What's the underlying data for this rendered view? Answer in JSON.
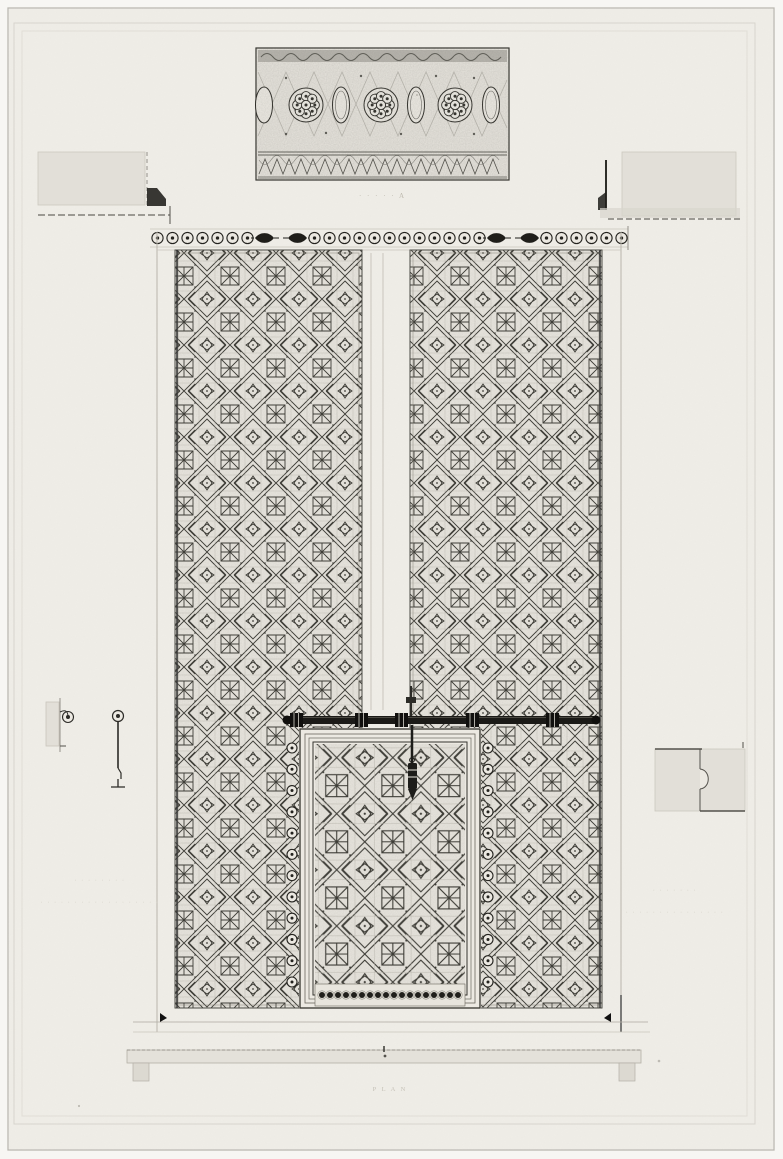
{
  "captions": {
    "frieze": "· · · · ·  A",
    "left_note": [
      "· · · · · · · ·",
      "· · ·  · · · ·  · · · · · · · ·  · · ·"
    ],
    "right_note": [
      "· · · · · · ·",
      "· · · ·  · · · · · · ·  · · · ·"
    ],
    "plan": "P L A N"
  },
  "colors": {
    "paper": "#f0eee8",
    "plate_paper": "#eeece6",
    "ink": "#26251f",
    "panel_field": "#e9e6df",
    "section_fill": "#e2dfd8",
    "faint_line": "#c6c2b9"
  },
  "ornament": {
    "stud_band_sequence": [
      "7",
      "wing_right",
      "gap",
      "wing_left",
      "12",
      "wing_right",
      "gap",
      "wing_left",
      "6"
    ],
    "stud_band_roundels": 25,
    "wicket_side_studs_per_side": 12,
    "wicket_bottom_studs": 18,
    "frieze_rosettes": 3,
    "frieze_cartouches": 4
  }
}
